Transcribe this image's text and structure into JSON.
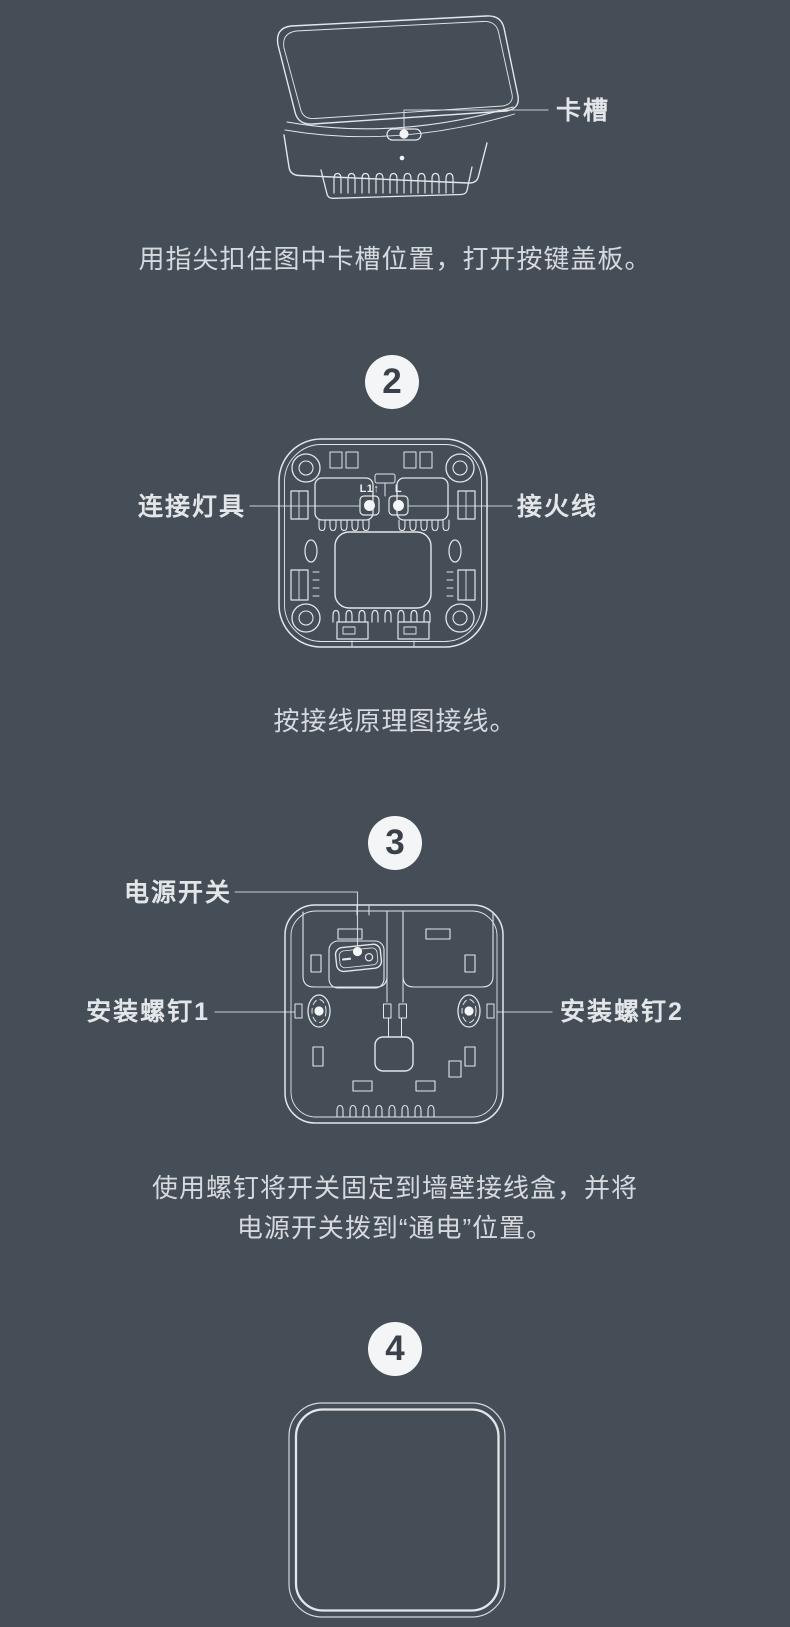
{
  "page": {
    "bg_color": "#454D57",
    "line_color": "#E4E7EA",
    "caption_color": "#D6D9DD",
    "label_color": "#E3E6E9",
    "badge_bg": "#F3F5F6",
    "badge_number_color": "#3A414B"
  },
  "step1": {
    "slot_label": "卡槽",
    "caption": "用指尖扣住图中卡槽位置，打开按键盖板。"
  },
  "step2": {
    "number": "2",
    "left_label": "连接灯具",
    "right_label": "接火线",
    "terminal_left": "L1↑",
    "terminal_right": "L",
    "caption": "按接线原理图接线。"
  },
  "step3": {
    "number": "3",
    "power_label": "电源开关",
    "screw1_label": "安装螺钉1",
    "screw2_label": "安装螺钉2",
    "caption_line1": "使用螺钉将开关固定到墙壁接线盒，并将",
    "caption_line2": "电源开关拨到“通电”位置。"
  },
  "step4": {
    "number": "4"
  }
}
